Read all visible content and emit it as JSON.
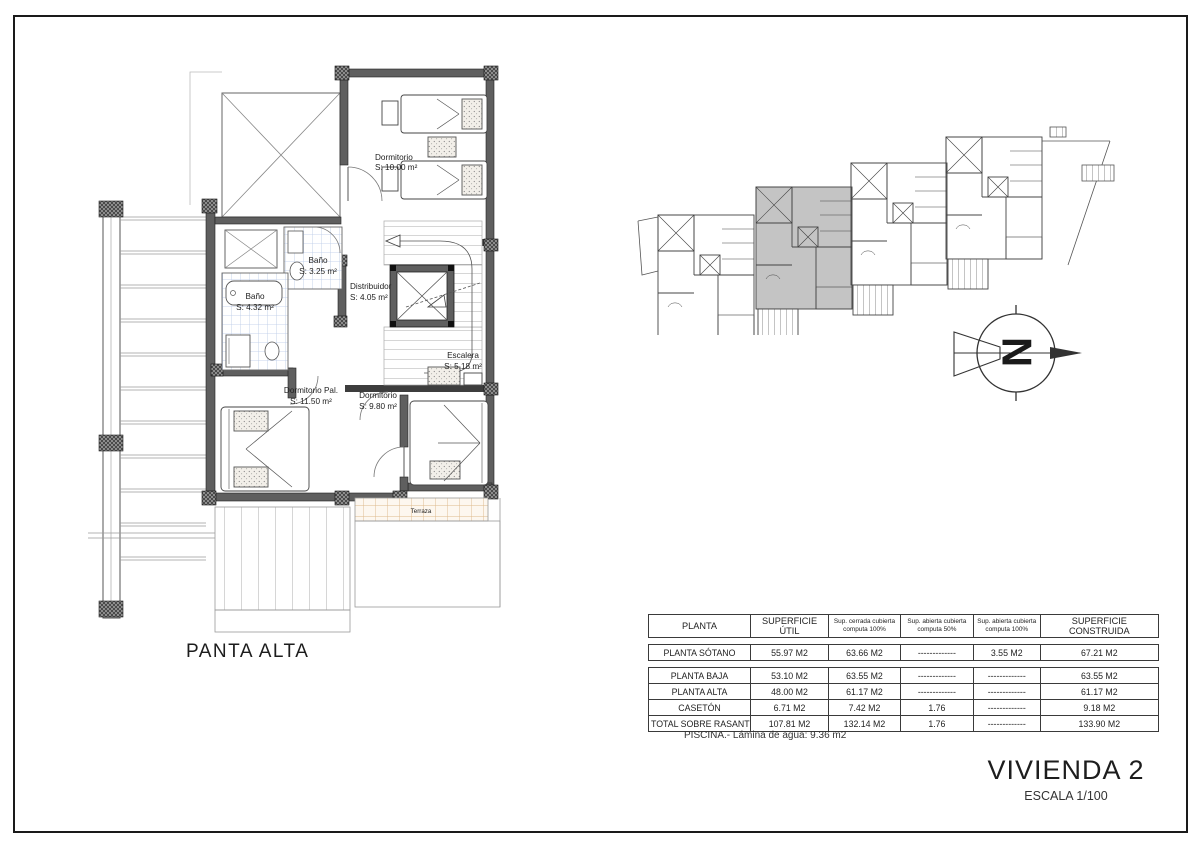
{
  "plan": {
    "title": "PANTA ALTA",
    "rooms": {
      "dormitorio_top": {
        "name": "Dormitorio",
        "area": "S: 10.00 m²"
      },
      "bano_small": {
        "name": "Baño",
        "area": "S: 3.25 m²"
      },
      "bano_large": {
        "name": "Baño",
        "area": "S: 4.32 m²"
      },
      "distribuidor": {
        "name": "Distribuidor",
        "area": "S: 4.05 m²"
      },
      "escalera": {
        "name": "Escalera",
        "area": "S: 5.18 m²"
      },
      "dormitorio_pal": {
        "name": "Dormitorio Pal.",
        "area": "S: 11.50 m²"
      },
      "dormitorio_2": {
        "name": "Dormitorio",
        "area": "S: 9.80 m²"
      },
      "terraza": {
        "name": "Terraza"
      }
    }
  },
  "north_arrow": {
    "label": "N"
  },
  "areas_table": {
    "headers": [
      "PLANTA",
      "SUPERFICIE ÚTIL",
      "Sup. cerrada cubierta computa 100%",
      "Sup. abierta cubierta computa 50%",
      "Sup. abierta cubierta computa 100%",
      "SUPERFICIE CONSTRUIDA"
    ],
    "rows": [
      [
        "PLANTA SÓTANO",
        "55.97 M2",
        "63.66 M2",
        "-------------",
        "3.55 M2",
        "67.21 M2"
      ],
      [
        "PLANTA BAJA",
        "53.10 M2",
        "63.55 M2",
        "-------------",
        "-------------",
        "63.55 M2"
      ],
      [
        "PLANTA ALTA",
        "48.00 M2",
        "61.17 M2",
        "-------------",
        "-------------",
        "61.17 M2"
      ],
      [
        "CASETÓN",
        "6.71 M2",
        "7.42 M2",
        "1.76",
        "-------------",
        "9.18 M2"
      ],
      [
        "TOTAL SOBRE RASANTE",
        "107.81 M2",
        "132.14 M2",
        "1.76",
        "-------------",
        "133.90 M2"
      ]
    ],
    "note": "PISCINA.- Lámina de agua: 9.36 m2"
  },
  "title_block": {
    "title": "VIVIENDA 2",
    "scale": "ESCALA 1/100"
  },
  "colors": {
    "wall": "#5f5f5f",
    "corner_block": "#3d3d3d",
    "tile_line": "#b9c9e6",
    "terrace_line": "#ddb88a",
    "highlighted_unit": "#c4c4c4",
    "frame": "#1a1a1a"
  }
}
